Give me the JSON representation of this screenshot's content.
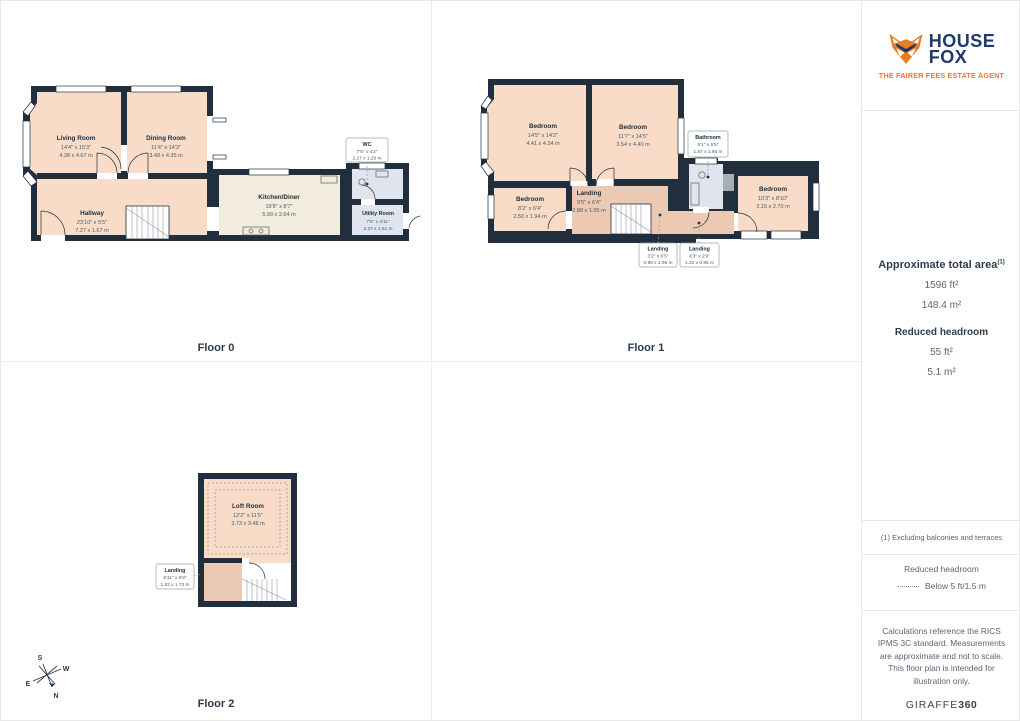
{
  "brand": {
    "line1": "HOUSE",
    "line2": "FOX",
    "tagline": "THE FAIRER FEES ESTATE AGENT"
  },
  "summary": {
    "title": "Approximate total area",
    "title_sup": "(1)",
    "area_ft": "1596 ft²",
    "area_m": "148.4 m²",
    "headroom_title": "Reduced headroom",
    "headroom_ft": "55 ft²",
    "headroom_m": "5.1 m²"
  },
  "notes": {
    "footnote": "(1) Excluding balconies and terraces",
    "legend_title": "Reduced headroom",
    "legend_item": "Below 5 ft/1.5 m",
    "disclaimer": "Calculations reference the RICS IPMS 3C standard. Measurements are approximate and not to scale. This floor plan is intended for illustration only.",
    "provider": "GIRAFFE",
    "provider_bold": "360"
  },
  "compass": {
    "n": "N",
    "s": "S",
    "e": "E",
    "w": "W"
  },
  "colors": {
    "wall": "#212e3e",
    "room_fill": "#f8dcc8",
    "landing_fill": "#ecc9b2",
    "kitchen_fill": "#f1ecdb",
    "wet_room_fill": "#dfe4ee",
    "brand_blue": "#1e3a6d",
    "brand_orange": "#f0762a"
  },
  "floors": [
    {
      "label": "Floor 0",
      "rooms": [
        {
          "name": "Living Room",
          "ft": "14'4\" x 15'3\"",
          "m": "4.38 x 4.67 m"
        },
        {
          "name": "Dining Room",
          "ft": "11'4\" x 14'3\"",
          "m": "3.48 x 4.35 m"
        },
        {
          "name": "Hallway",
          "ft": "23'10\" x 5'5\"",
          "m": "7.27 x 1.67 m"
        },
        {
          "name": "Kitchen/Diner",
          "ft": "19'8\" x 8'7\"",
          "m": "5.99 x 2.64 m"
        },
        {
          "name": "WC",
          "ft": "7'5\" x 4'2\"",
          "m": "2.27 x 1.29 m"
        },
        {
          "name": "Utility Room",
          "ft": "7'5\" x 4'11\"",
          "m": "2.27 x 1.51 m"
        }
      ]
    },
    {
      "label": "Floor 1",
      "rooms": [
        {
          "name": "Bedroom",
          "ft": "14'5\" x 14'2\"",
          "m": "4.41 x 4.34 m"
        },
        {
          "name": "Bedroom",
          "ft": "11'7\" x 14'5\"",
          "m": "3.54 x 4.40 m"
        },
        {
          "name": "Bathroom",
          "ft": "5'1\" x 5'5\"",
          "m": "1.57 x 1.66 m"
        },
        {
          "name": "Bedroom",
          "ft": "10'3\" x 8'10\"",
          "m": "3.15 x 2.70 m"
        },
        {
          "name": "Bedroom",
          "ft": "8'2\" x 6'4\"",
          "m": "2.50 x 1.94 m"
        },
        {
          "name": "Landing",
          "ft": "9'5\" x 6'4\"",
          "m": "2.88 x 1.95 m"
        },
        {
          "name": "Landing",
          "ft": "3'2\" x 6'5\"",
          "m": "0.98 x 1.96 m"
        },
        {
          "name": "Landing",
          "ft": "4'3\" x 2'9\"",
          "m": "1.31 x 0.85 m"
        }
      ]
    },
    {
      "label": "Floor 2",
      "rooms": [
        {
          "name": "Loft Room",
          "ft": "12'2\" x 11'5\"",
          "m": "3.73 x 3.48 m"
        },
        {
          "name": "Landing",
          "ft": "5'11\" x 5'8\"",
          "m": "1.83 x 1.73 m"
        }
      ]
    }
  ]
}
